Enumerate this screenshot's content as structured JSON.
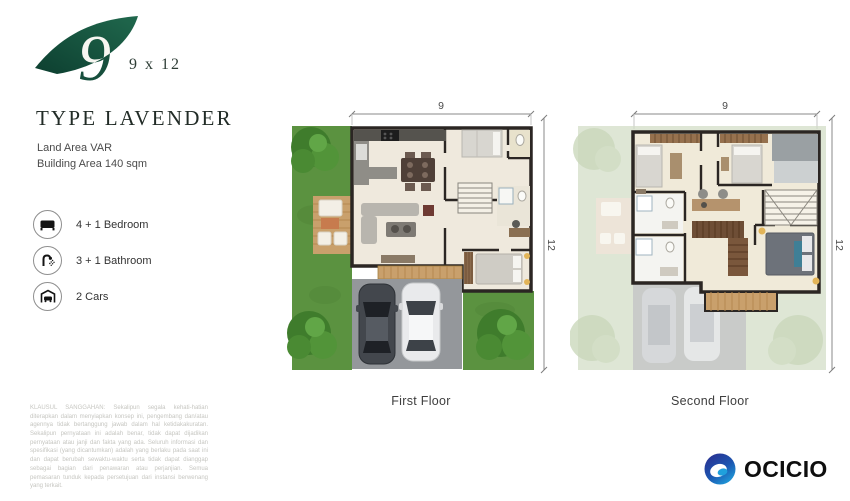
{
  "brand": {
    "logo_number": "9",
    "logo_dimensions": "9 x 12",
    "type_title": "TYPE LAVENDER",
    "land_area": "Land Area VAR",
    "building_area": "Building Area 140 sqm"
  },
  "features": [
    {
      "icon": "bed-icon",
      "label": "4 + 1 Bedroom"
    },
    {
      "icon": "shower-icon",
      "label": "3 + 1 Bathroom"
    },
    {
      "icon": "garage-car-icon",
      "label": "2 Cars"
    }
  ],
  "disclaimer": "KLAUSUL SANGGAHAN: Sekalipun segala kehati-hatian diterapkan dalam menyiapkan konsep ini, pengembang dan/atau agennya tidak bertanggung jawab dalam hal ketidakakuratan. Sekalipun pernyataan ini adalah benar, tidak dapat dijadikan pernyataan atau janji dan fakta yang ada. Seluruh informasi dan spesifikasi (yang dicantumkan) adalah yang berlaku pada saat ini dan dapat berubah sewaktu-waktu serta tidak dapat dianggap sebagai bagian dari penawaran atau perjanjian. Semua pemasaran tunduk kepada persetujuan dari instansi berwenang yang terkait.",
  "plans": {
    "first": {
      "label": "First Floor",
      "width_dim": "9",
      "height_dim": "12"
    },
    "second": {
      "label": "Second Floor",
      "width_dim": "9",
      "height_dim": "12"
    }
  },
  "footer": {
    "brand_name": "OCICIO"
  },
  "colors": {
    "logo_green_dark": "#0d3f30",
    "logo_green": "#1f6a4e",
    "grass": "#5b9240",
    "deck": "#c9a06c",
    "driveway": "#94979b",
    "wall": "#2b2623",
    "floor": "#efe9dd",
    "ocicio_navy": "#2b2e8f",
    "ocicio_blue": "#1fa0dc"
  }
}
